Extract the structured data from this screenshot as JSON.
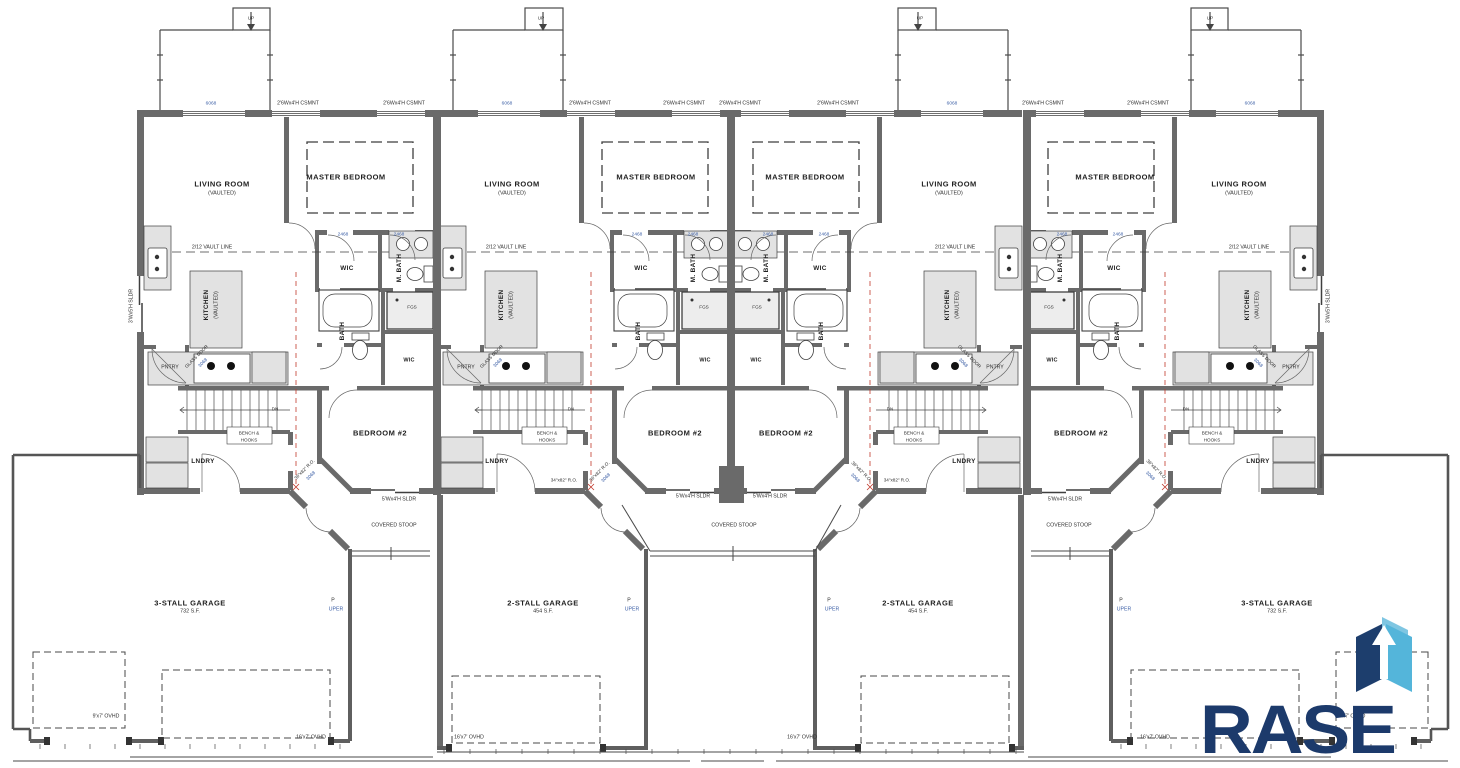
{
  "logo": {
    "name": "RASE",
    "navy": "#1c3a6b",
    "light_blue": "#54b5da",
    "pale_blue": "#7fc6e2"
  },
  "plan_summary": {
    "building": "Four-unit townhome main level plan",
    "unit_rooms": [
      "LIVING ROOM (VAULTED)",
      "MASTER BEDROOM",
      "KITCHEN (VAULTED)",
      "WIC",
      "M. BATH",
      "BATH",
      "PNTRY",
      "LNDRY",
      "BEDROOM #2"
    ],
    "garages": [
      "3-STALL GARAGE 732 S.F.",
      "2-STALL GARAGE 454 S.F.",
      "2-STALL GARAGE 454 S.F.",
      "3-STALL GARAGE 732 S.F."
    ],
    "stoops": [
      "COVERED STOOP",
      "COVERED STOOP",
      "COVERED STOOP"
    ]
  },
  "annotations": [
    {
      "t": "2'6Wx4'H CSMNT",
      "x": 298,
      "y": 104,
      "s": "tiny"
    },
    {
      "t": "2'6Wx4'H CSMNT",
      "x": 404,
      "y": 104,
      "s": "tiny"
    },
    {
      "t": "2'6Wx4'H CSMNT",
      "x": 590,
      "y": 104,
      "s": "tiny"
    },
    {
      "t": "2'6Wx4'H CSMNT",
      "x": 684,
      "y": 104,
      "s": "tiny"
    },
    {
      "t": "2'6Wx4'H CSMNT",
      "x": 740,
      "y": 104,
      "s": "tiny"
    },
    {
      "t": "2'6Wx4'H CSMNT",
      "x": 838,
      "y": 104,
      "s": "tiny"
    },
    {
      "t": "2'6Wx4'H CSMNT",
      "x": 1043,
      "y": 104,
      "s": "tiny"
    },
    {
      "t": "2'6Wx4'H CSMNT",
      "x": 1148,
      "y": 104,
      "s": "tiny"
    },
    {
      "t": "6068",
      "x": 211,
      "y": 105,
      "s": "tag"
    },
    {
      "t": "6068",
      "x": 507,
      "y": 105,
      "s": "tag"
    },
    {
      "t": "6068",
      "x": 952,
      "y": 105,
      "s": "tag"
    },
    {
      "t": "6068",
      "x": 1250,
      "y": 105,
      "s": "tag"
    },
    {
      "t": "UP",
      "x": 251,
      "y": 19,
      "s": "micro"
    },
    {
      "t": "UP",
      "x": 541,
      "y": 19,
      "s": "micro"
    },
    {
      "t": "UP",
      "x": 920,
      "y": 19,
      "s": "micro"
    },
    {
      "t": "UP",
      "x": 1210,
      "y": 19,
      "s": "micro"
    },
    {
      "t": "LIVING ROOM",
      "x": 222,
      "y": 184,
      "s": "room"
    },
    {
      "t": "LIVING ROOM",
      "x": 512,
      "y": 184,
      "s": "room"
    },
    {
      "t": "LIVING ROOM",
      "x": 949,
      "y": 184,
      "s": "room"
    },
    {
      "t": "LIVING ROOM",
      "x": 1239,
      "y": 184,
      "s": "room"
    },
    {
      "t": "(VAULTED)",
      "x": 222,
      "y": 194,
      "s": "sub"
    },
    {
      "t": "(VAULTED)",
      "x": 512,
      "y": 194,
      "s": "sub"
    },
    {
      "t": "(VAULTED)",
      "x": 949,
      "y": 194,
      "s": "sub"
    },
    {
      "t": "(VAULTED)",
      "x": 1239,
      "y": 194,
      "s": "sub"
    },
    {
      "t": "MASTER BEDROOM",
      "x": 346,
      "y": 177,
      "s": "room"
    },
    {
      "t": "MASTER BEDROOM",
      "x": 656,
      "y": 177,
      "s": "room"
    },
    {
      "t": "MASTER BEDROOM",
      "x": 805,
      "y": 177,
      "s": "room"
    },
    {
      "t": "MASTER BEDROOM",
      "x": 1115,
      "y": 177,
      "s": "room"
    },
    {
      "t": "2/12 VAULT LINE",
      "x": 212,
      "y": 248,
      "s": "tiny"
    },
    {
      "t": "2/12 VAULT LINE",
      "x": 506,
      "y": 248,
      "s": "tiny"
    },
    {
      "t": "2/12 VAULT LINE",
      "x": 955,
      "y": 248,
      "s": "tiny"
    },
    {
      "t": "2/12 VAULT LINE",
      "x": 1249,
      "y": 248,
      "s": "tiny"
    },
    {
      "t": "WIC",
      "x": 347,
      "y": 269,
      "s": "room2"
    },
    {
      "t": "WIC",
      "x": 641,
      "y": 269,
      "s": "room2"
    },
    {
      "t": "WIC",
      "x": 820,
      "y": 269,
      "s": "room2"
    },
    {
      "t": "WIC",
      "x": 1114,
      "y": 269,
      "s": "room2"
    },
    {
      "t": "M. BATH",
      "x": 400,
      "y": 268,
      "s": "room2",
      "r": -90
    },
    {
      "t": "M. BATH",
      "x": 694,
      "y": 268,
      "s": "room2",
      "r": -90
    },
    {
      "t": "M. BATH",
      "x": 767,
      "y": 268,
      "s": "room2",
      "r": -90
    },
    {
      "t": "M. BATH",
      "x": 1061,
      "y": 268,
      "s": "room2",
      "r": -90
    },
    {
      "t": "BATH",
      "x": 343,
      "y": 331,
      "s": "room2",
      "r": -90
    },
    {
      "t": "BATH",
      "x": 639,
      "y": 331,
      "s": "room2",
      "r": -90
    },
    {
      "t": "BATH",
      "x": 822,
      "y": 331,
      "s": "room2",
      "r": -90
    },
    {
      "t": "BATH",
      "x": 1118,
      "y": 331,
      "s": "room2",
      "r": -90
    },
    {
      "t": "FGS",
      "x": 412,
      "y": 308,
      "s": "micro"
    },
    {
      "t": "FGS",
      "x": 704,
      "y": 308,
      "s": "micro"
    },
    {
      "t": "FGS",
      "x": 757,
      "y": 308,
      "s": "micro"
    },
    {
      "t": "FGS",
      "x": 1049,
      "y": 308,
      "s": "micro"
    },
    {
      "t": "KITCHEN",
      "x": 207,
      "y": 305,
      "s": "room2",
      "r": -90
    },
    {
      "t": "KITCHEN",
      "x": 502,
      "y": 305,
      "s": "room2",
      "r": -90
    },
    {
      "t": "KITCHEN",
      "x": 948,
      "y": 305,
      "s": "room2",
      "r": -90
    },
    {
      "t": "KITCHEN",
      "x": 1248,
      "y": 305,
      "s": "room2",
      "r": -90
    },
    {
      "t": "(VAULTED)",
      "x": 217,
      "y": 305,
      "s": "sub",
      "r": -90
    },
    {
      "t": "(VAULTED)",
      "x": 512,
      "y": 305,
      "s": "sub",
      "r": -90
    },
    {
      "t": "(VAULTED)",
      "x": 958,
      "y": 305,
      "s": "sub",
      "r": -90
    },
    {
      "t": "(VAULTED)",
      "x": 1258,
      "y": 305,
      "s": "sub",
      "r": -90
    },
    {
      "t": "PNTRY",
      "x": 170,
      "y": 368,
      "s": "tiny"
    },
    {
      "t": "PNTRY",
      "x": 466,
      "y": 368,
      "s": "tiny"
    },
    {
      "t": "PNTRY",
      "x": 995,
      "y": 368,
      "s": "tiny"
    },
    {
      "t": "PNTRY",
      "x": 1291,
      "y": 368,
      "s": "tiny"
    },
    {
      "t": "GLASS DOOR",
      "x": 197,
      "y": 357,
      "s": "micro",
      "r": -45
    },
    {
      "t": "GLASS DOOR",
      "x": 492,
      "y": 357,
      "s": "micro",
      "r": -45
    },
    {
      "t": "GLASS DOOR",
      "x": 969,
      "y": 357,
      "s": "micro",
      "r": 45
    },
    {
      "t": "GLASS DOOR",
      "x": 1264,
      "y": 357,
      "s": "micro",
      "r": 45
    },
    {
      "t": "3068",
      "x": 204,
      "y": 364,
      "s": "tag",
      "r": -45
    },
    {
      "t": "3068",
      "x": 499,
      "y": 364,
      "s": "tag",
      "r": -45
    },
    {
      "t": "3068",
      "x": 962,
      "y": 364,
      "s": "tag",
      "r": 45
    },
    {
      "t": "3068",
      "x": 1257,
      "y": 364,
      "s": "tag",
      "r": 45
    },
    {
      "t": "WIC",
      "x": 409,
      "y": 361,
      "s": "room3"
    },
    {
      "t": "WIC",
      "x": 705,
      "y": 361,
      "s": "room3"
    },
    {
      "t": "WIC",
      "x": 756,
      "y": 361,
      "s": "room3"
    },
    {
      "t": "WIC",
      "x": 1052,
      "y": 361,
      "s": "room3"
    },
    {
      "t": "BEDROOM #2",
      "x": 380,
      "y": 433,
      "s": "room"
    },
    {
      "t": "BEDROOM #2",
      "x": 675,
      "y": 433,
      "s": "room"
    },
    {
      "t": "BEDROOM #2",
      "x": 786,
      "y": 433,
      "s": "room"
    },
    {
      "t": "BEDROOM #2",
      "x": 1081,
      "y": 433,
      "s": "room"
    },
    {
      "t": "BENCH &",
      "x": 249,
      "y": 434,
      "s": "micro"
    },
    {
      "t": "BENCH &",
      "x": 547,
      "y": 434,
      "s": "micro"
    },
    {
      "t": "BENCH &",
      "x": 914,
      "y": 434,
      "s": "micro"
    },
    {
      "t": "BENCH &",
      "x": 1212,
      "y": 434,
      "s": "micro"
    },
    {
      "t": "HOOKS",
      "x": 249,
      "y": 441,
      "s": "micro"
    },
    {
      "t": "HOOKS",
      "x": 547,
      "y": 441,
      "s": "micro"
    },
    {
      "t": "HOOKS",
      "x": 914,
      "y": 441,
      "s": "micro"
    },
    {
      "t": "HOOKS",
      "x": 1212,
      "y": 441,
      "s": "micro"
    },
    {
      "t": "LNDRY",
      "x": 203,
      "y": 462,
      "s": "room2"
    },
    {
      "t": "LNDRY",
      "x": 497,
      "y": 462,
      "s": "room2"
    },
    {
      "t": "LNDRY",
      "x": 964,
      "y": 462,
      "s": "room2"
    },
    {
      "t": "LNDRY",
      "x": 1258,
      "y": 462,
      "s": "room2"
    },
    {
      "t": "DN",
      "x": 275,
      "y": 410,
      "s": "micro"
    },
    {
      "t": "DN",
      "x": 571,
      "y": 410,
      "s": "micro"
    },
    {
      "t": "DN",
      "x": 890,
      "y": 410,
      "s": "micro"
    },
    {
      "t": "DN",
      "x": 1186,
      "y": 410,
      "s": "micro"
    },
    {
      "t": "36\"x82\" R.O.",
      "x": 305,
      "y": 470,
      "s": "micro",
      "r": -45
    },
    {
      "t": "36\"x82\" R.O.",
      "x": 600,
      "y": 472,
      "s": "micro",
      "r": -45
    },
    {
      "t": "36\"x82\" R.O.",
      "x": 861,
      "y": 472,
      "s": "micro",
      "r": 45
    },
    {
      "t": "36\"x82\" R.O.",
      "x": 1156,
      "y": 470,
      "s": "micro",
      "r": 45
    },
    {
      "t": "3068",
      "x": 312,
      "y": 477,
      "s": "tag",
      "r": -45
    },
    {
      "t": "3068",
      "x": 607,
      "y": 479,
      "s": "tag",
      "r": -45
    },
    {
      "t": "3068",
      "x": 854,
      "y": 479,
      "s": "tag",
      "r": 45
    },
    {
      "t": "3068",
      "x": 1149,
      "y": 477,
      "s": "tag",
      "r": 45
    },
    {
      "t": "34\"x82\" R.O.",
      "x": 564,
      "y": 481,
      "s": "micro"
    },
    {
      "t": "34\"x82\" R.O.",
      "x": 897,
      "y": 481,
      "s": "micro"
    },
    {
      "t": "5'Wx4'H SLDR",
      "x": 399,
      "y": 500,
      "s": "tiny"
    },
    {
      "t": "5'Wx4'H SLDR",
      "x": 693,
      "y": 497,
      "s": "tiny"
    },
    {
      "t": "5'Wx4'H SLDR",
      "x": 770,
      "y": 497,
      "s": "tiny"
    },
    {
      "t": "5'Wx4'H SLDR",
      "x": 1065,
      "y": 500,
      "s": "tiny"
    },
    {
      "t": "COVERED STOOP",
      "x": 394,
      "y": 526,
      "s": "tiny"
    },
    {
      "t": "COVERED STOOP",
      "x": 734,
      "y": 526,
      "s": "tiny"
    },
    {
      "t": "COVERED STOOP",
      "x": 1069,
      "y": 526,
      "s": "tiny"
    },
    {
      "t": "3-STALL GARAGE",
      "x": 190,
      "y": 603,
      "s": "room"
    },
    {
      "t": "3-STALL GARAGE",
      "x": 1277,
      "y": 603,
      "s": "room"
    },
    {
      "t": "732 S.F.",
      "x": 190,
      "y": 612,
      "s": "sub"
    },
    {
      "t": "732 S.F.",
      "x": 1277,
      "y": 612,
      "s": "sub"
    },
    {
      "t": "2-STALL GARAGE",
      "x": 543,
      "y": 603,
      "s": "room"
    },
    {
      "t": "2-STALL GARAGE",
      "x": 918,
      "y": 603,
      "s": "room"
    },
    {
      "t": "454 S.F.",
      "x": 543,
      "y": 612,
      "s": "sub"
    },
    {
      "t": "454 S.F.",
      "x": 918,
      "y": 612,
      "s": "sub"
    },
    {
      "t": "P",
      "x": 333,
      "y": 601,
      "s": "tiny"
    },
    {
      "t": "P",
      "x": 629,
      "y": 601,
      "s": "tiny"
    },
    {
      "t": "P",
      "x": 829,
      "y": 601,
      "s": "tiny"
    },
    {
      "t": "P",
      "x": 1121,
      "y": 601,
      "s": "tiny"
    },
    {
      "t": "UPER",
      "x": 336,
      "y": 610,
      "s": "tagb"
    },
    {
      "t": "UPER",
      "x": 632,
      "y": 610,
      "s": "tagb"
    },
    {
      "t": "UPER",
      "x": 832,
      "y": 610,
      "s": "tagb"
    },
    {
      "t": "UPER",
      "x": 1124,
      "y": 610,
      "s": "tagb"
    },
    {
      "t": "9'x7' OVHD",
      "x": 106,
      "y": 717,
      "s": "tiny"
    },
    {
      "t": "9'x7' OVHD",
      "x": 1352,
      "y": 717,
      "s": "tiny"
    },
    {
      "t": "16'x7' OVHD",
      "x": 311,
      "y": 738,
      "s": "tiny"
    },
    {
      "t": "16'x7' OVHD",
      "x": 469,
      "y": 738,
      "s": "tiny"
    },
    {
      "t": "16'x7' OVHD",
      "x": 802,
      "y": 738,
      "s": "tiny"
    },
    {
      "t": "16'x7' OVHD",
      "x": 1155,
      "y": 738,
      "s": "tiny"
    },
    {
      "t": "3'Wx5'H SLDR",
      "x": 132,
      "y": 306,
      "s": "tiny",
      "r": -90
    },
    {
      "t": "3'Wx5'H SLDR",
      "x": 1329,
      "y": 306,
      "s": "tiny",
      "r": -90
    },
    {
      "t": "2468",
      "x": 343,
      "y": 236,
      "s": "tag"
    },
    {
      "t": "2468",
      "x": 399,
      "y": 236,
      "s": "tag"
    },
    {
      "t": "2468",
      "x": 637,
      "y": 236,
      "s": "tag"
    },
    {
      "t": "2468",
      "x": 693,
      "y": 236,
      "s": "tag"
    },
    {
      "t": "2468",
      "x": 768,
      "y": 236,
      "s": "tag"
    },
    {
      "t": "2468",
      "x": 824,
      "y": 236,
      "s": "tag"
    },
    {
      "t": "2468",
      "x": 1062,
      "y": 236,
      "s": "tag"
    },
    {
      "t": "2468",
      "x": 1118,
      "y": 236,
      "s": "tag"
    }
  ]
}
